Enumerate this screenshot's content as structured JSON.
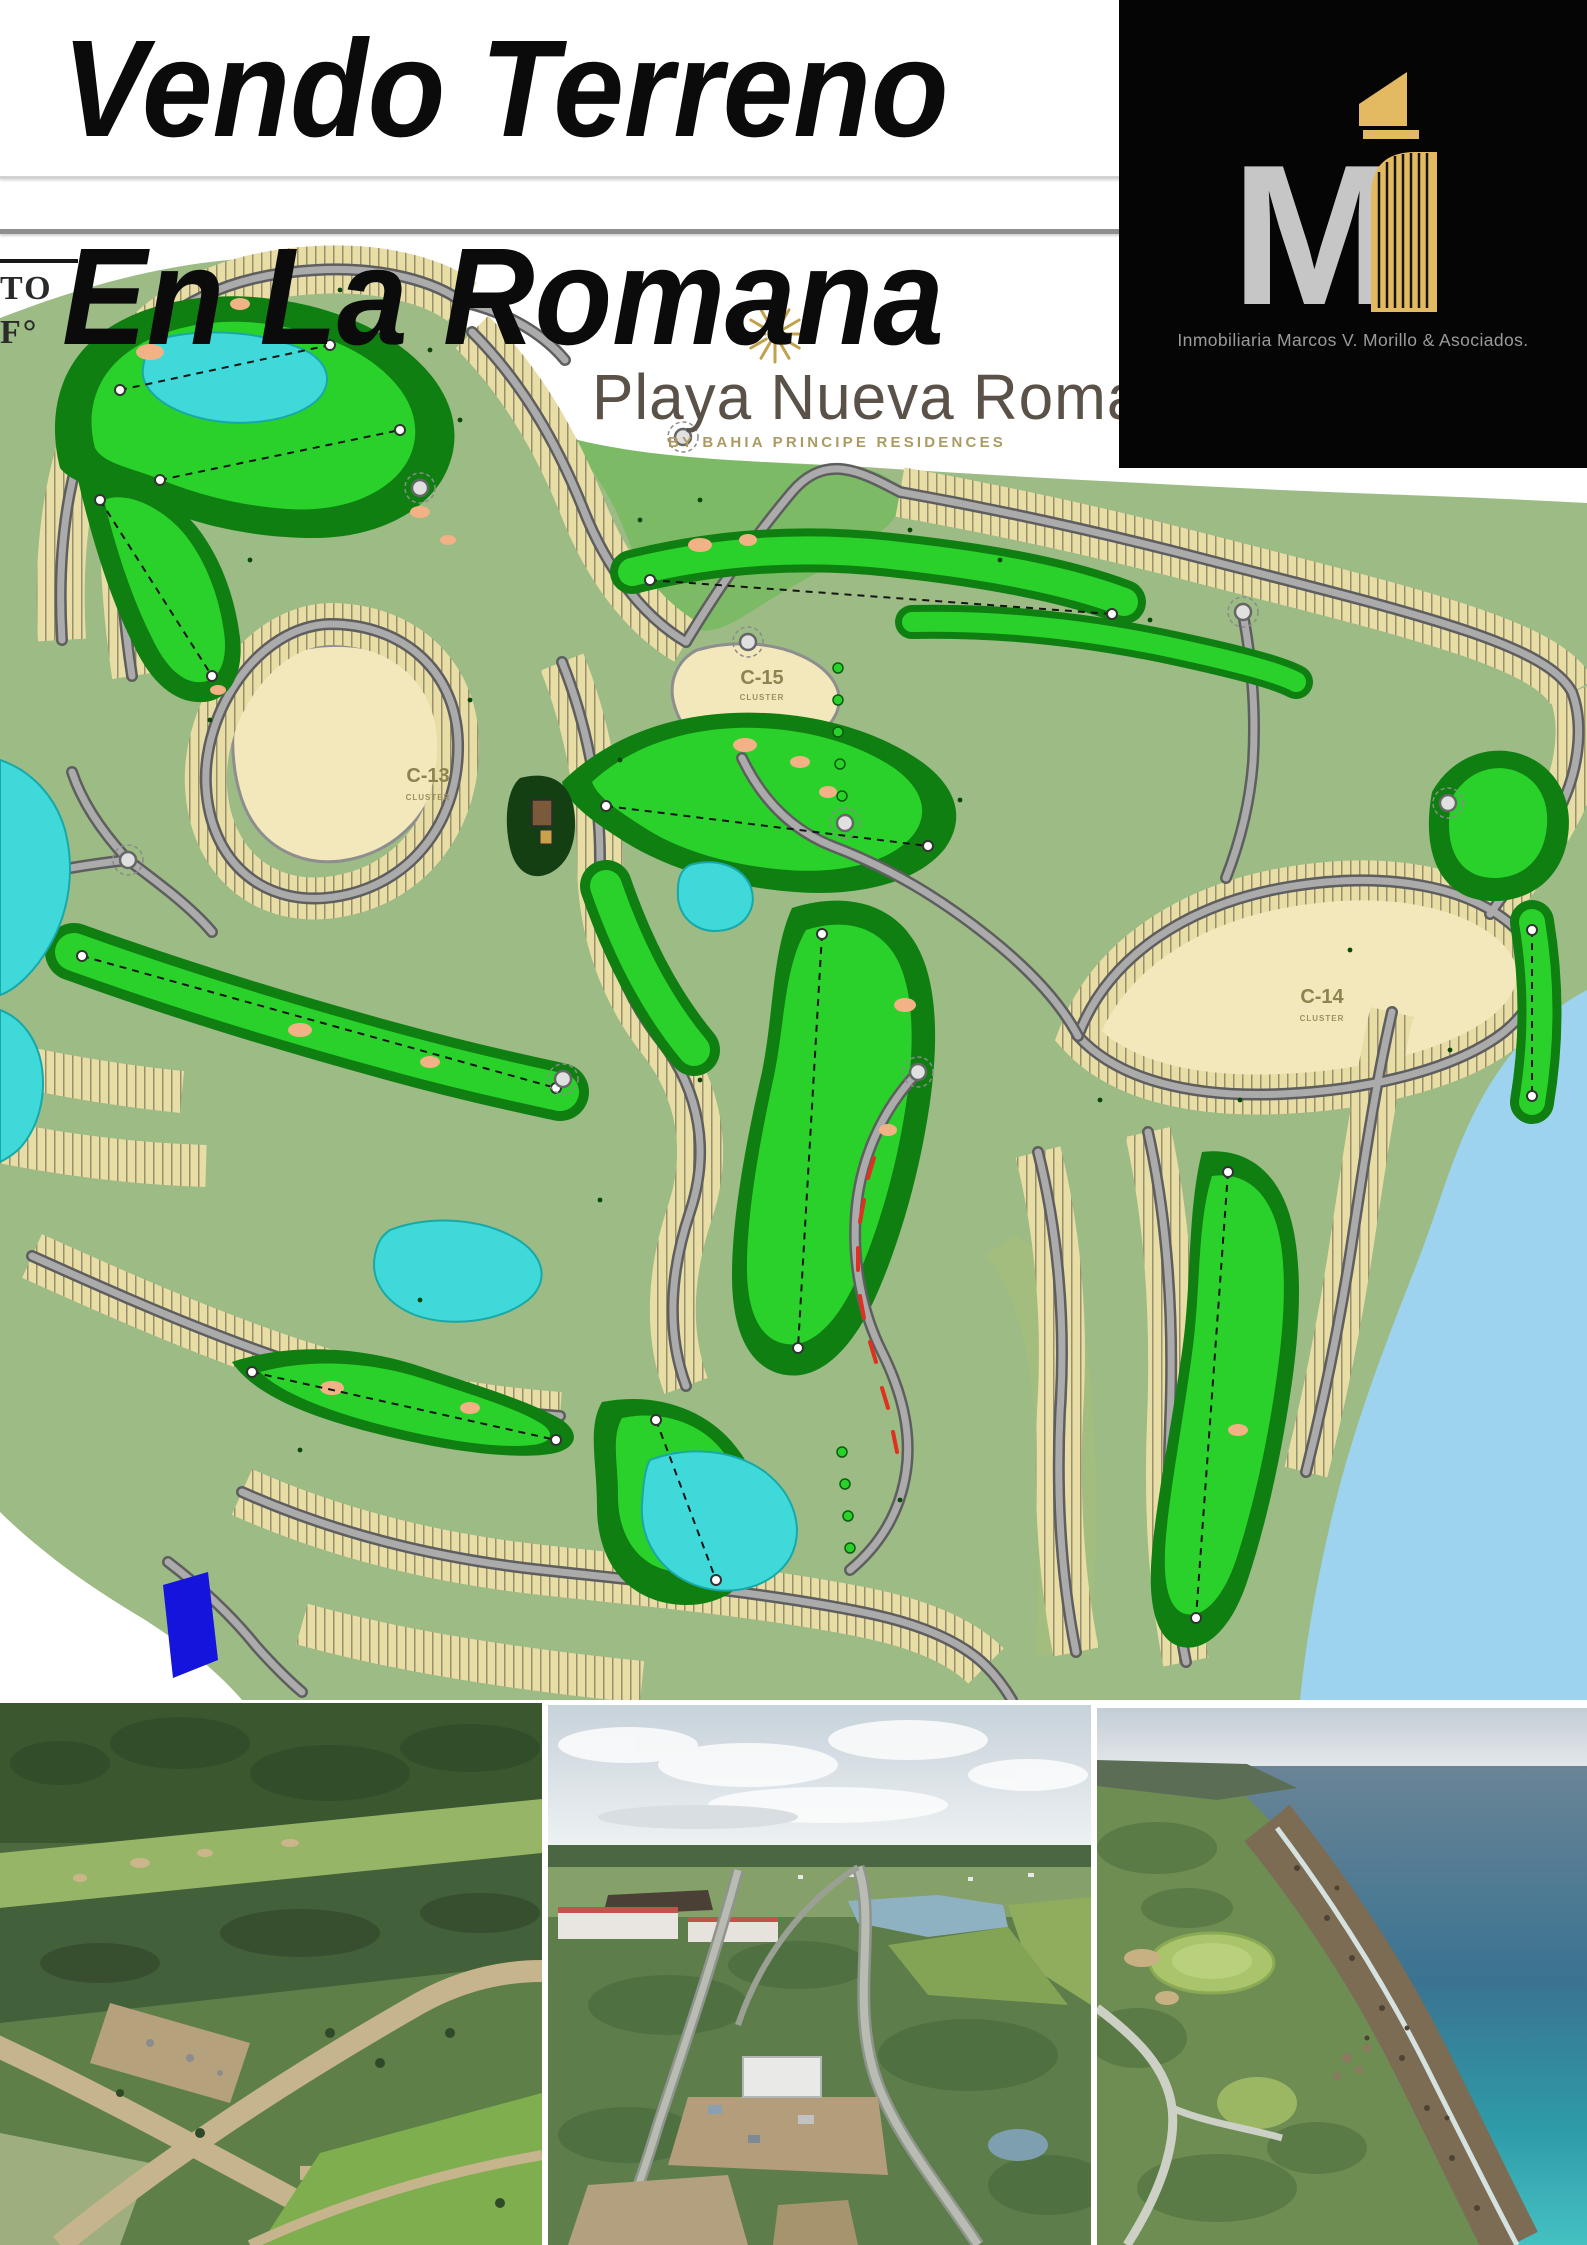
{
  "header": {
    "title_line1": "Vendo Terreno",
    "title_line2": "En La Romana",
    "fragment_line1": "TO",
    "fragment_line2": "F°"
  },
  "brand": {
    "resort_name": "Playa Nueva Romana",
    "resort_tagline": "BY BAHIA PRINCIPE RESIDENCES",
    "sun_icon": "sun-rays-icon",
    "gold": "#c2a14d",
    "text_color": "#5a5148"
  },
  "logo": {
    "monogram": "M",
    "company": "Inmobiliaria Marcos V. Morillo & Asociados.",
    "background": "#050505",
    "monogram_color": "#c6c6c6",
    "building_color": "#e3ba62",
    "company_color": "#9b9b9b",
    "building_icon": "building-monogram-icon"
  },
  "map": {
    "clusters": [
      {
        "id": "C-13",
        "sub": "CLUSTER"
      },
      {
        "id": "C-15",
        "sub": "CLUSTER"
      },
      {
        "id": "C-14",
        "sub": "CLUSTER"
      }
    ],
    "palette": {
      "land": "#9cbb85",
      "meadow": "#7cba66",
      "fairway_dark": "#0f7f12",
      "fairway_bright": "#2bd12b",
      "lots": "#e9dda6",
      "cluster_fill": "#f2e8bc",
      "road": "#ababab",
      "water": "#3fd9d9",
      "ocean": "#9dd3ef",
      "bunker": "#f3b285",
      "highlight_lot": "#1414dd",
      "alert": "#e03020"
    }
  },
  "photos": [
    {
      "name": "aerial-golf-fairways"
    },
    {
      "name": "aerial-development-road"
    },
    {
      "name": "cliff-coast-golf-hole"
    }
  ]
}
